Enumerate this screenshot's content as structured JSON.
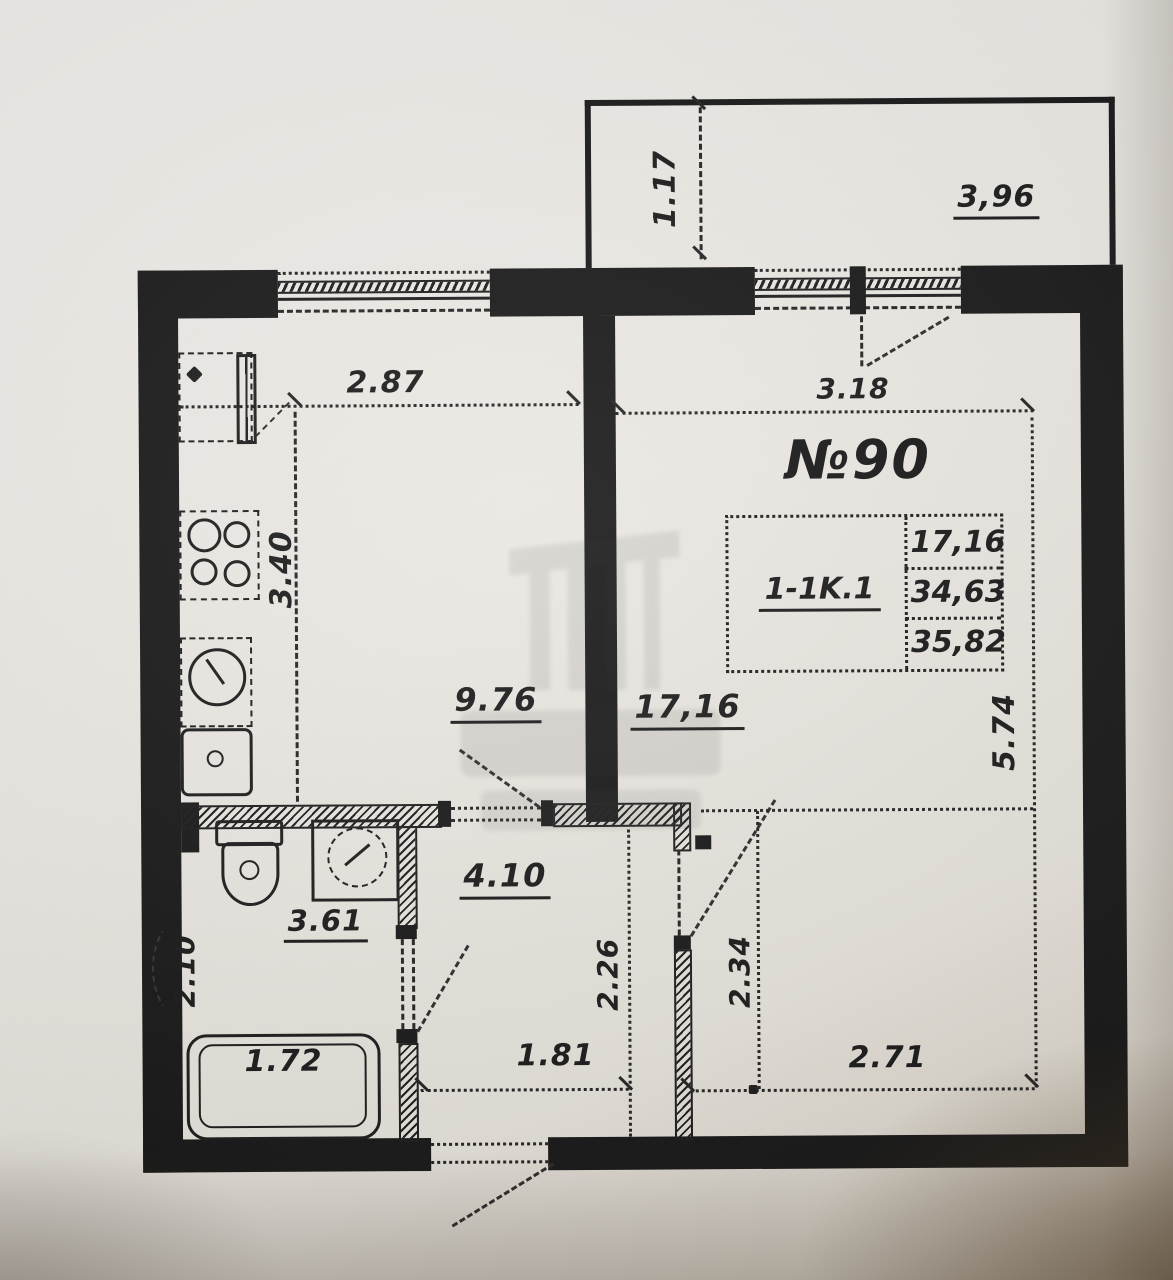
{
  "plan": {
    "apartment_number": "№90",
    "unit_table": {
      "unit_type": "1-1K.1",
      "living_area": "17,16",
      "apartment_area": "34,63",
      "total_area": "35,82"
    },
    "areas": {
      "living_room": "17,16",
      "kitchen": "9.76",
      "hallway": "4.10",
      "bathroom": "3.61"
    },
    "dimensions": {
      "balcony_depth": "1.17",
      "balcony_width": "3,96",
      "kitchen_width": "2.87",
      "kitchen_depth": "3.40",
      "living_width_top": "3.18",
      "living_depth": "5.74",
      "living_width_bottom": "2.71",
      "bathroom_depth": "2.10",
      "bathtub_width": "1.72",
      "hallway_width": "1.81",
      "hallway_depth": "2.26",
      "hallway_depth_right": "2.34"
    }
  }
}
